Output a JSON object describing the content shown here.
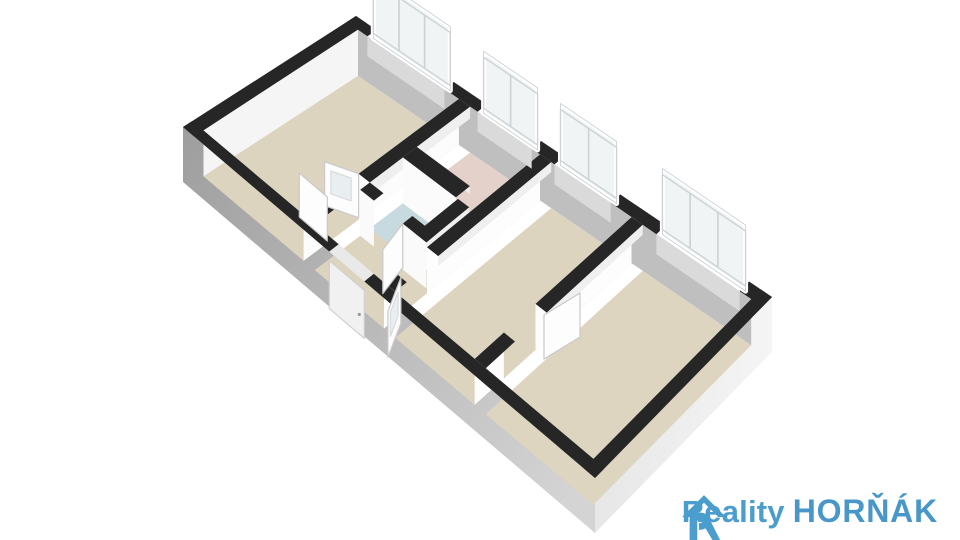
{
  "meta": {
    "app": "3D floor plan render",
    "description": "Axonometric 3D floor plan of an apartment, viewed from above"
  },
  "logo": {
    "reality_label": "Reality",
    "hornak_label": "HORŇÁK",
    "brand_color": "#4b9dce",
    "hornak_color": "#4897c8",
    "icon": "house-r-icon"
  },
  "floor_plan": {
    "corners": {
      "A": [
        356,
        16
      ],
      "D": [
        772,
        297
      ],
      "B": [
        183,
        127
      ],
      "C": [
        595,
        478
      ]
    },
    "wall_height": 46,
    "outer_wall_height": 55,
    "colors": {
      "wall_top": "#262626",
      "outer_sw_dark": "#9e9e9e",
      "outer_sw_light": "#d4d4d4",
      "outer_se": "#f3f3f3",
      "outer_se_shade": "#e7e7e7",
      "inner_north_face": "#bfbfbf",
      "inner_west_face": "#f5f5f5",
      "inner_thin_face": "#efefef",
      "interior_face": "#fcfcfc",
      "window_frame": "#ffffff",
      "window_pane": "#f1f4f5",
      "window_pane_line": "#ccd2d5",
      "sill": "#dadada",
      "door_leaf": "#fdfdfd",
      "door_leaf_edge": "#c9c9c9",
      "door_glass": "#e9eef0",
      "entrance_door": "#f1f1f1",
      "lintel": "#e9e9e9"
    },
    "rooms": [
      {
        "name": "living-room",
        "rect": [
          0.027,
          0.054,
          0.27,
          0.946
        ],
        "floor_color": "#ddd4c0"
      },
      {
        "name": "hallway",
        "rect": [
          0.297,
          0.36,
          0.465,
          0.946
        ],
        "floor_color": "#ddd4c0"
      },
      {
        "name": "pink-room",
        "rect": [
          0.297,
          0.054,
          0.465,
          0.36
        ],
        "floor_color": "#e3d1ca"
      },
      {
        "name": "bathroom",
        "rect": [
          0.297,
          0.44,
          0.457,
          0.63
        ],
        "floor_color": "#c6dae0"
      },
      {
        "name": "middle-room",
        "rect": [
          0.492,
          0.054,
          0.685,
          0.946
        ],
        "floor_color": "#ddd4c0"
      },
      {
        "name": "right-room",
        "rect": [
          0.712,
          0.054,
          0.973,
          0.946
        ],
        "floor_color": "#ded5c1"
      }
    ],
    "faces": [
      {
        "name": "north-wall-inner-face",
        "edge": [
          0.027,
          0.054,
          0.973,
          0.054
        ],
        "h": 46,
        "color": "#bfbfbf"
      },
      {
        "name": "west-wall-inner-face",
        "edge": [
          0.027,
          0.054,
          0.027,
          0.946
        ],
        "h": 46,
        "color": "#f5f5f5"
      },
      {
        "name": "wall-a-west-face",
        "edge": [
          0.27,
          0.054,
          0.27,
          0.63
        ],
        "h": 46,
        "color": "#fcfcfc"
      },
      {
        "name": "wall-a-west-face2",
        "edge": [
          0.27,
          0.81,
          0.27,
          0.946
        ],
        "h": 46,
        "color": "#fcfcfc"
      },
      {
        "name": "wall-a-east-face",
        "edge": [
          0.297,
          0.054,
          0.297,
          0.63
        ],
        "h": 12,
        "color": "#efefef"
      },
      {
        "name": "pink-south-face",
        "edge": [
          0.297,
          0.44,
          0.425,
          0.44
        ],
        "h": 46,
        "color": "#fbfbfb"
      },
      {
        "name": "pink-north-thin",
        "edge": [
          0.297,
          0.36,
          0.425,
          0.36
        ],
        "h": 8,
        "color": "#ededed"
      },
      {
        "name": "wc-east-west-face",
        "edge": [
          0.43,
          0.44,
          0.43,
          0.685
        ],
        "h": 46,
        "color": "#fcfcfc"
      },
      {
        "name": "wc-east-thin",
        "edge": [
          0.457,
          0.44,
          0.457,
          0.685
        ],
        "h": 10,
        "color": "#efefef"
      },
      {
        "name": "wc-south-face",
        "edge": [
          0.297,
          0.685,
          0.33,
          0.685
        ],
        "h": 46,
        "color": "#fafafa"
      },
      {
        "name": "wc-south-face2",
        "edge": [
          0.4,
          0.685,
          0.457,
          0.685
        ],
        "h": 46,
        "color": "#fafafa"
      },
      {
        "name": "wall-b-west-face",
        "edge": [
          0.465,
          0.054,
          0.465,
          0.7
        ],
        "h": 46,
        "color": "#fdfdfd"
      },
      {
        "name": "wall-b-west-face2",
        "edge": [
          0.465,
          0.88,
          0.465,
          0.946
        ],
        "h": 46,
        "color": "#fdfdfd"
      },
      {
        "name": "wall-b-east-thin",
        "edge": [
          0.492,
          0.054,
          0.492,
          0.7
        ],
        "h": 10,
        "color": "#efefef"
      },
      {
        "name": "wall-c-west-face",
        "edge": [
          0.685,
          0.054,
          0.685,
          0.6
        ],
        "h": 46,
        "color": "#fdfdfd"
      },
      {
        "name": "wall-c-west-face2",
        "edge": [
          0.685,
          0.78,
          0.685,
          0.946
        ],
        "h": 46,
        "color": "#fdfdfd"
      },
      {
        "name": "wall-c-east-thin",
        "edge": [
          0.712,
          0.054,
          0.712,
          0.6
        ],
        "h": 10,
        "color": "#efefef"
      },
      {
        "name": "south-wall-inner-thin",
        "edge": [
          0.027,
          0.946,
          0.973,
          0.946
        ],
        "h": 8,
        "color": "#f0f0f0"
      },
      {
        "name": "east-wall-inner-thin",
        "edge": [
          0.973,
          0.054,
          0.973,
          0.946
        ],
        "h": 14,
        "color": "#ededed"
      }
    ],
    "tops": [
      {
        "name": "north-wall-top",
        "rect": [
          0.0,
          0.0,
          0.05,
          0.054
        ]
      },
      {
        "name": "north-wall-top",
        "rect": [
          0.235,
          0.0,
          0.315,
          0.054
        ]
      },
      {
        "name": "north-wall-top",
        "rect": [
          0.445,
          0.0,
          0.5,
          0.054
        ]
      },
      {
        "name": "north-wall-top",
        "rect": [
          0.635,
          0.0,
          0.745,
          0.054
        ]
      },
      {
        "name": "north-wall-top",
        "rect": [
          0.945,
          0.0,
          1.0,
          0.054
        ]
      },
      {
        "name": "west-wall-top",
        "rect": [
          0.0,
          0.0,
          0.027,
          1.0
        ]
      },
      {
        "name": "south-wall-top",
        "rect": [
          0.0,
          0.946,
          0.355,
          1.0
        ]
      },
      {
        "name": "south-wall-top",
        "rect": [
          0.44,
          0.946,
          1.0,
          1.0
        ]
      },
      {
        "name": "east-wall-top",
        "rect": [
          0.973,
          0.0,
          1.0,
          1.0
        ]
      },
      {
        "name": "wall-a-top",
        "rect": [
          0.27,
          0.054,
          0.297,
          0.63
        ]
      },
      {
        "name": "wall-a-top",
        "rect": [
          0.27,
          0.81,
          0.297,
          0.946
        ]
      },
      {
        "name": "pink-south-top",
        "rect": [
          0.297,
          0.36,
          0.425,
          0.44
        ]
      },
      {
        "name": "wc-east-top",
        "rect": [
          0.43,
          0.44,
          0.457,
          0.685
        ]
      },
      {
        "name": "wc-south-top",
        "rect": [
          0.297,
          0.63,
          0.33,
          0.685
        ]
      },
      {
        "name": "wc-south-top",
        "rect": [
          0.4,
          0.63,
          0.457,
          0.685
        ]
      },
      {
        "name": "wall-b-top",
        "rect": [
          0.465,
          0.054,
          0.492,
          0.7
        ]
      },
      {
        "name": "wall-b-top",
        "rect": [
          0.465,
          0.88,
          0.492,
          0.946
        ]
      },
      {
        "name": "wall-c-top",
        "rect": [
          0.685,
          0.054,
          0.712,
          0.6
        ]
      },
      {
        "name": "wall-c-top",
        "rect": [
          0.685,
          0.78,
          0.712,
          0.946
        ]
      }
    ],
    "windows": [
      {
        "name": "window-living",
        "u0": 0.05,
        "u1": 0.235,
        "panes": 3,
        "height": 58
      },
      {
        "name": "window-pink",
        "u0": 0.315,
        "u1": 0.445,
        "panes": 2,
        "height": 56
      },
      {
        "name": "window-middle",
        "u0": 0.5,
        "u1": 0.635,
        "panes": 2,
        "height": 56
      },
      {
        "name": "window-right",
        "u0": 0.745,
        "u1": 0.945,
        "panes": 3,
        "height": 60
      }
    ],
    "door_leaves": [
      {
        "name": "door-living-leaf",
        "hinge": [
          0.27,
          0.63
        ],
        "dir": [
          -34,
          -12
        ],
        "h": 44,
        "glazed": true
      },
      {
        "name": "door-living-leaf2",
        "hinge": [
          0.27,
          0.81
        ],
        "dir": [
          -28,
          -24
        ],
        "h": 44,
        "glazed": false
      },
      {
        "name": "door-bathroom-leaf",
        "hinge": [
          0.4,
          0.685
        ],
        "dir": [
          -20,
          26
        ],
        "h": 44,
        "glazed": false
      },
      {
        "name": "door-hall-leaf",
        "hinge": [
          0.478,
          0.88
        ],
        "dir": [
          -13,
          34
        ],
        "h": 46,
        "glazed": true
      },
      {
        "name": "door-room34-leaf",
        "hinge": [
          0.712,
          0.615
        ],
        "dir": [
          36,
          -22
        ],
        "h": 44,
        "glazed": false
      }
    ],
    "entrance": {
      "name": "entrance-door",
      "u0": 0.355,
      "u1": 0.44
    }
  }
}
